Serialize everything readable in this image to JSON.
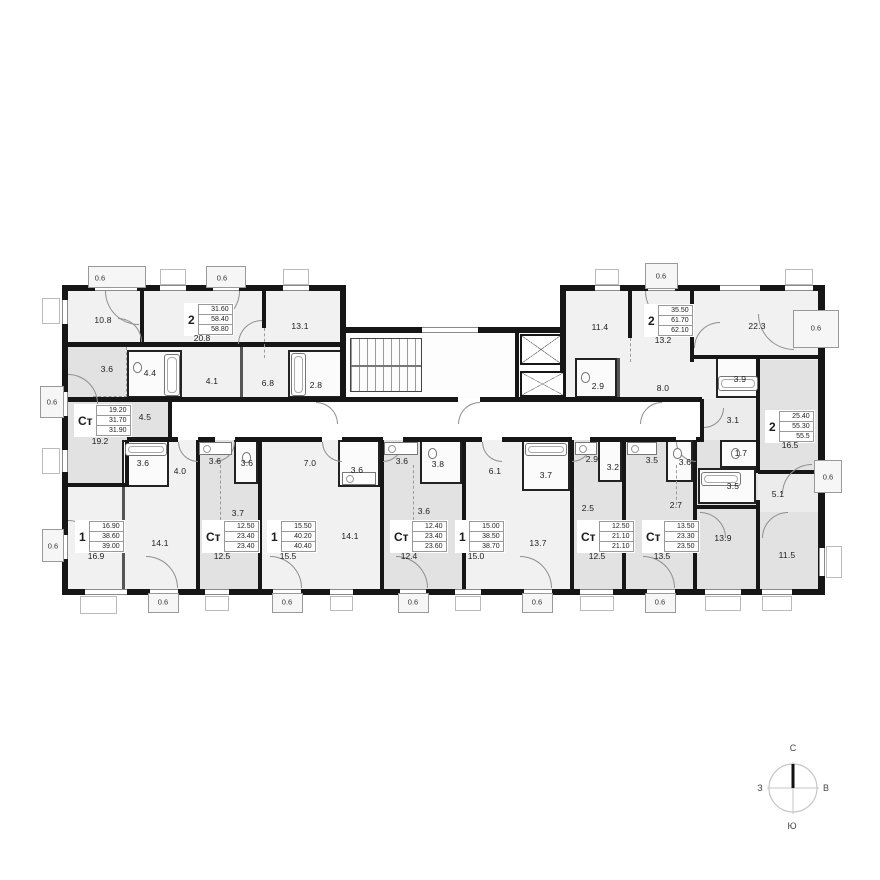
{
  "units": {
    "u1": {
      "type": "2",
      "a1": "31.60",
      "a2": "58.40",
      "a3": "58.80",
      "main": "20.8"
    },
    "u2": {
      "type": "Ст",
      "a1": "19.20",
      "a2": "31.70",
      "a3": "31.90",
      "main": "19.2"
    },
    "u3": {
      "type": "2",
      "a1": "35.50",
      "a2": "61.70",
      "a3": "62.10",
      "main": "13.2"
    },
    "u4": {
      "type": "2",
      "a1": "25.40",
      "a2": "55.30",
      "a3": "55.5",
      "main": "16.5"
    },
    "u5": {
      "type": "1",
      "a1": "16.90",
      "a2": "38.60",
      "a3": "39.00",
      "main": "16.9"
    },
    "u6": {
      "type": "Ст",
      "a1": "12.50",
      "a2": "23.40",
      "a3": "23.40",
      "main": "12.5"
    },
    "u7": {
      "type": "1",
      "a1": "15.50",
      "a2": "40.20",
      "a3": "40.40",
      "main": "15.5"
    },
    "u8": {
      "type": "Ст",
      "a1": "12.40",
      "a2": "23.40",
      "a3": "23.60",
      "main": "12.4"
    },
    "u9": {
      "type": "1",
      "a1": "15.00",
      "a2": "38.50",
      "a3": "38.70",
      "main": "15.0"
    },
    "u10": {
      "type": "Ст",
      "a1": "12.50",
      "a2": "21.10",
      "a3": "21.10",
      "main": "12.5"
    },
    "u11": {
      "type": "Ст",
      "a1": "13.50",
      "a2": "23.30",
      "a3": "23.50",
      "main": "13.5"
    }
  },
  "rooms": {
    "tl_bed": "10.8",
    "tl_liv2": "13.1",
    "tl_bath": "4.4",
    "tl_hall": "4.1",
    "tl_corr": "6.8",
    "tl_wc": "2.8",
    "st1_kit": "3.6",
    "st1_hall": "4.5",
    "tr_bed": "11.4",
    "tr_liv": "22.3",
    "tr_wc": "2.9",
    "tr_hall": "8.0",
    "tr_bath": "3.9",
    "r_hall": "3.1",
    "r_wc": "1.7",
    "r_bath": "3.5",
    "r_corr": "5.1",
    "r_bed1": "13.9",
    "r_bed2": "11.5",
    "b1_bath": "3.6",
    "b1_hall": "4.0",
    "b1_liv": "14.1",
    "st2_kit": "3.6",
    "st2_bath": "3.6",
    "st2_hall": "3.7",
    "b2_kit": "7.0",
    "b2_bath": "3.6",
    "b2_liv": "14.1",
    "st3_kit": "3.6",
    "st3_bath": "3.8",
    "st3_hall": "3.6",
    "b3_kit": "6.1",
    "b3_bath": "3.7",
    "b3_liv": "13.7",
    "st4_kit": "2.9",
    "st4_bath": "3.2",
    "st4_hall": "2.5",
    "st5_kit": "3.5",
    "st5_bath": "3.6",
    "st5_hall": "2.7"
  },
  "balcony_area": "0.6",
  "compass": {
    "north": "С",
    "south": "Ю",
    "west": "З",
    "east": "В"
  }
}
